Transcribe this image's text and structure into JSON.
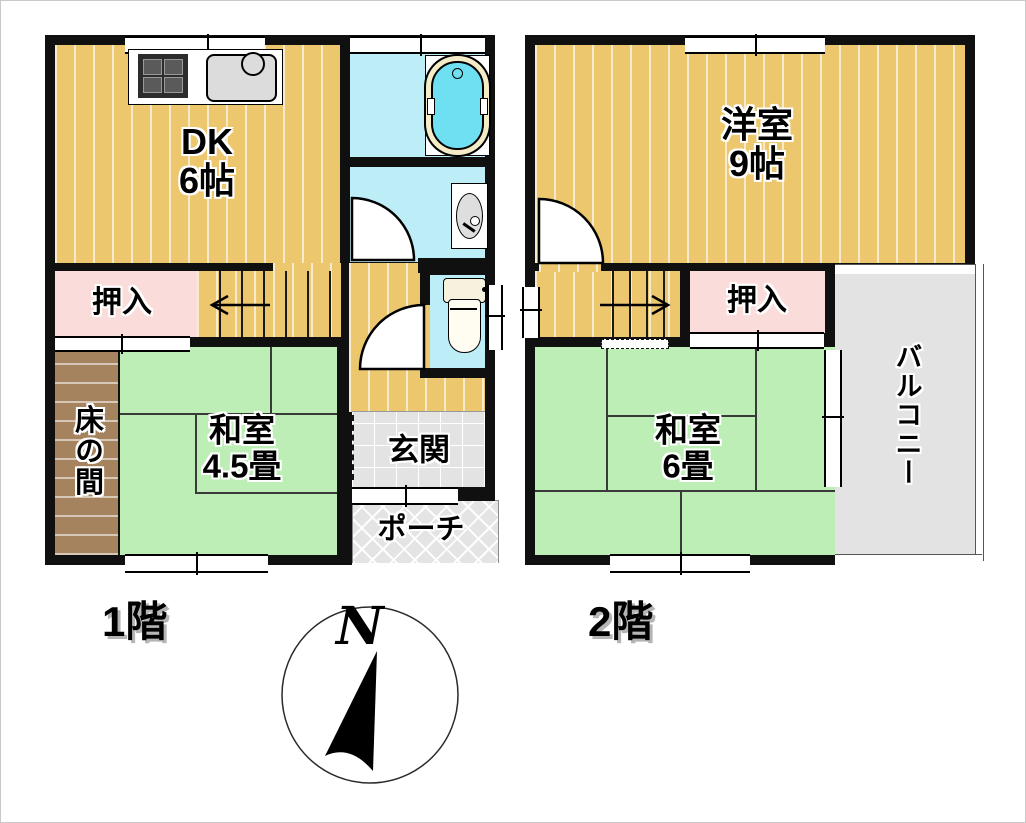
{
  "floor1": {
    "label": "1階",
    "rooms": {
      "dk": {
        "name": "DK",
        "size": "6帖"
      },
      "oshiire": {
        "label": "押入"
      },
      "tokonoma": {
        "label": "床の間"
      },
      "washitsu": {
        "name": "和室",
        "size": "4.5畳"
      },
      "genkan": {
        "label": "玄関"
      },
      "porch": {
        "label": "ポーチ"
      }
    }
  },
  "floor2": {
    "label": "2階",
    "rooms": {
      "youshitsu": {
        "name": "洋室",
        "size": "9帖"
      },
      "oshiire": {
        "label": "押入"
      },
      "washitsu": {
        "name": "和室",
        "size": "6畳"
      },
      "balcony": {
        "label": "バルコニー"
      }
    }
  },
  "compass": {
    "north": "N"
  },
  "icons": {
    "stove": "gas-stove",
    "sink": "kitchen-sink",
    "bathtub": "bathtub",
    "washbasin": "washbasin",
    "toilet": "toilet",
    "compass": "compass-rose",
    "stairs_down": "arrow-left",
    "stairs_up": "arrow-right"
  },
  "colors": {
    "wood_floor": "#ecc76d",
    "tatami_green": "#bceeb6",
    "closet_pink": "#fadcda",
    "water_cyan": "#bdeef8",
    "tokonoma_brown": "#a6835f",
    "entry_gray": "#e3e3e3",
    "wall": "#101010"
  }
}
